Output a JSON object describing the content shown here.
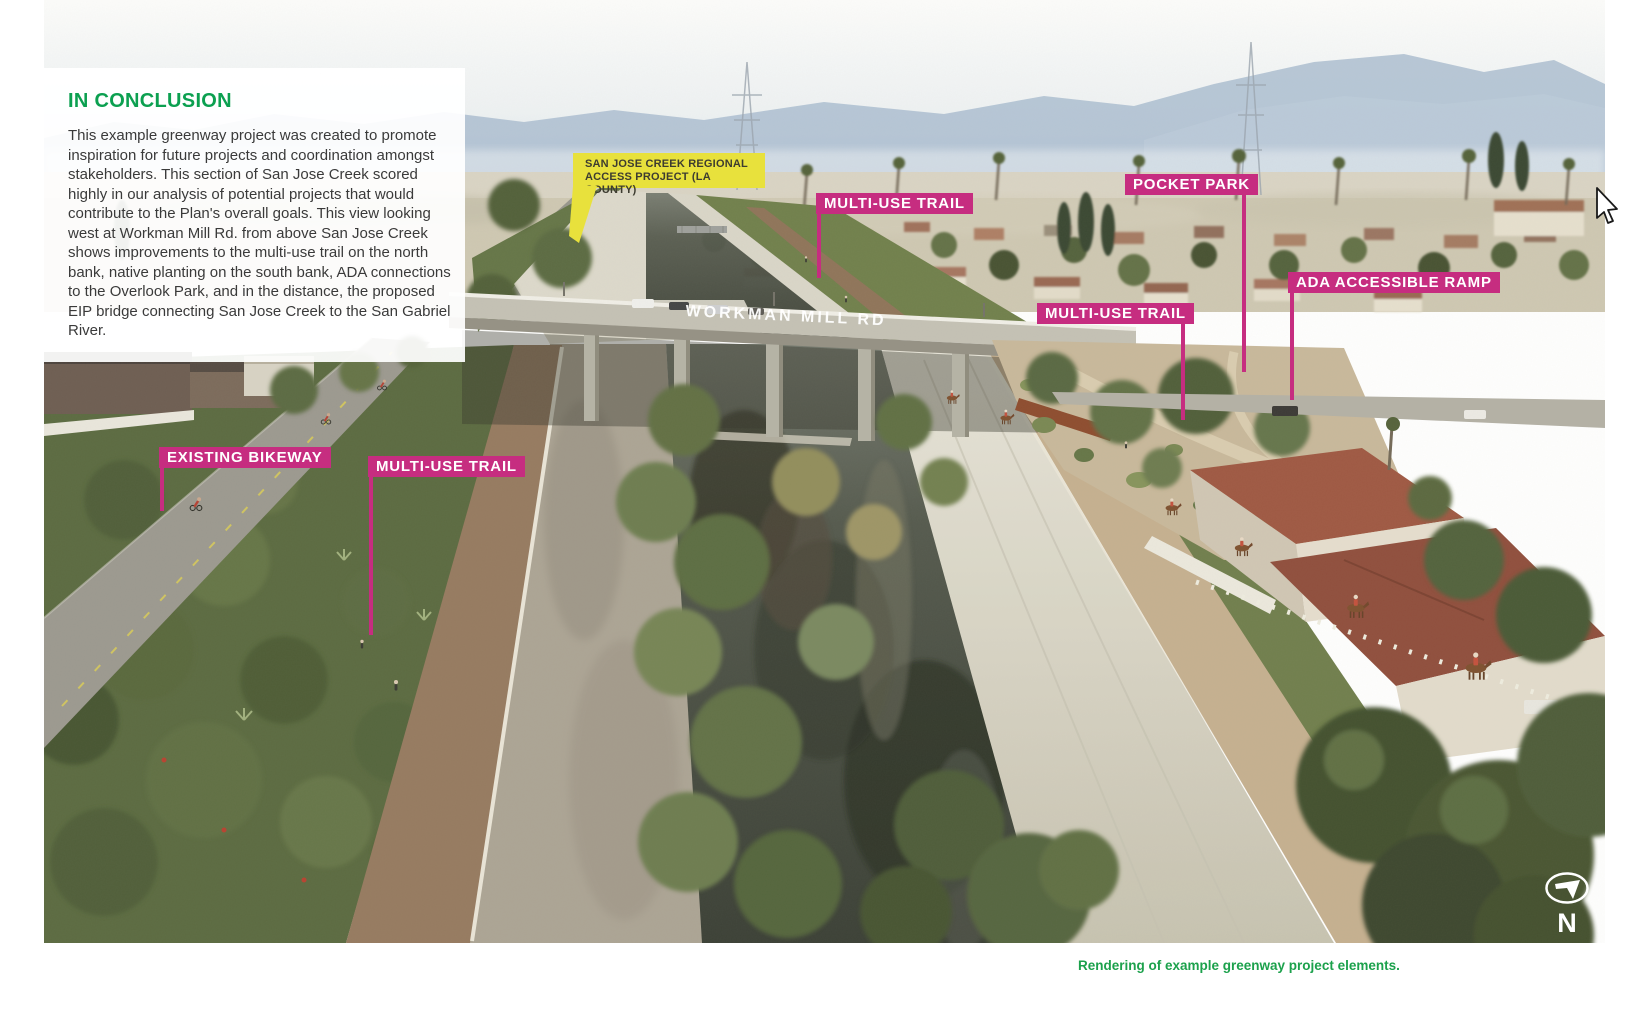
{
  "page": {
    "background": "#ffffff"
  },
  "conclusion_panel": {
    "heading": "IN CONCLUSION",
    "heading_color": "#0BA050",
    "body": "This example greenway project was created to promote inspiration for future projects and coordination amongst stakeholders. This section of San Jose Creek scored highly in our analysis of potential projects that would contribute to the Plan's overall goals. This view looking west at Workman Mill Rd. from above San Jose Creek shows improvements to the multi-use trail on the north bank, native planting on the south bank, ADA connections to the Overlook Park, and in the distance, the proposed EIP bridge connecting San Jose Creek to the San Gabriel River."
  },
  "callouts": {
    "yellow": {
      "line1": "SAN JOSE CREEK REGIONAL",
      "line2": "ACCESS PROJECT (LA COUNTY)",
      "bg_color": "#E8E13C",
      "text_color": "#3D3C30"
    },
    "pink_color": "#C62D80",
    "labels": [
      {
        "id": "multi-use-trail-upper",
        "text": "MULTI-USE TRAIL"
      },
      {
        "id": "pocket-park",
        "text": "POCKET PARK"
      },
      {
        "id": "ada-accessible-ramp",
        "text": "ADA ACCESSIBLE RAMP"
      },
      {
        "id": "multi-use-trail-right",
        "text": "MULTI-USE TRAIL"
      },
      {
        "id": "existing-bikeway",
        "text": "EXISTING BIKEWAY"
      },
      {
        "id": "multi-use-trail-left",
        "text": "MULTI-USE TRAIL"
      }
    ]
  },
  "photo": {
    "road_label": "WORKMAN MILL RD",
    "north_label": "N"
  },
  "caption": {
    "text": "Rendering of example greenway project elements.",
    "color": "#1CA14C"
  }
}
